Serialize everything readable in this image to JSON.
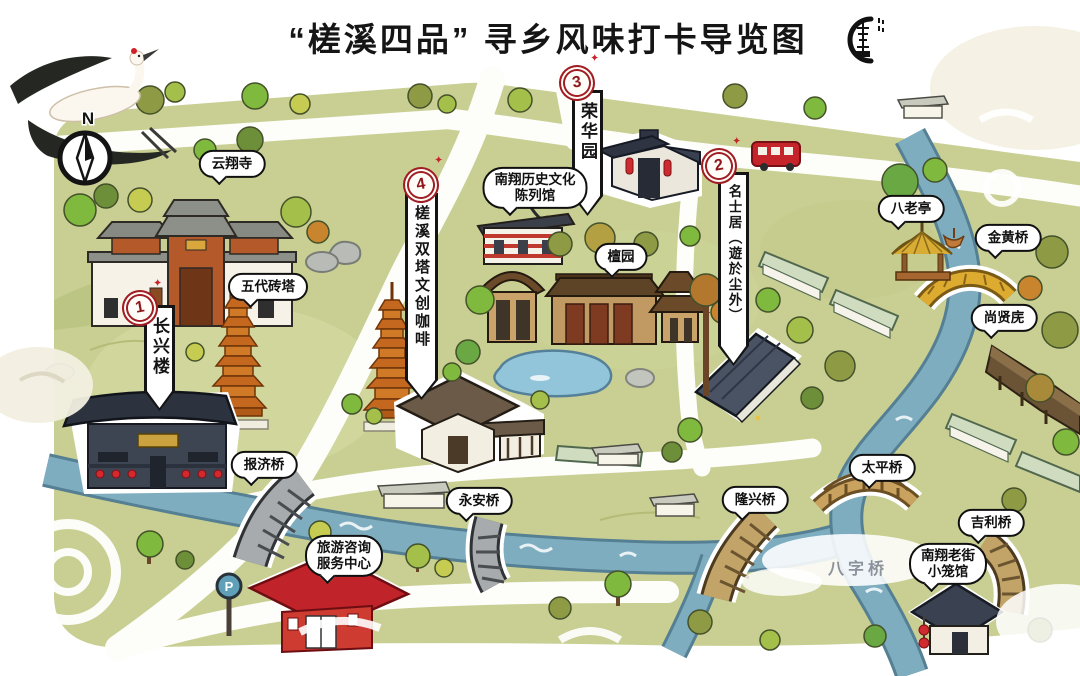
{
  "title": "“槎溪四品” 寻乡风味打卡导览图",
  "compass": {
    "label": "N"
  },
  "parking": {
    "label": "P"
  },
  "decor": {
    "sparkle": "✦"
  },
  "water_label": "八字桥",
  "markers": [
    {
      "num": "1",
      "label": "长兴楼"
    },
    {
      "num": "2",
      "label": "名士居（遊於尘外）"
    },
    {
      "num": "3",
      "label": "荣华园"
    },
    {
      "num": "4",
      "label": "槎溪双塔文创咖啡"
    }
  ],
  "bubbles": {
    "yunxiang_temple": "云翔寺",
    "five_dynasties_pagoda": "五代砖塔",
    "history_museum_line1": "南翔历史文化",
    "history_museum_line2": "陈列馆",
    "tan_garden": "檀园",
    "balao_pavilion": "八老亭",
    "jinhuang_bridge": "金黄桥",
    "shangxian_gallery": "尚贤庑",
    "baoji_bridge": "报济桥",
    "yongan_bridge": "永安桥",
    "longxing_bridge": "隆兴桥",
    "taiping_bridge": "太平桥",
    "jili_bridge": "吉利桥",
    "xiaolong_hall_line1": "南翔老街",
    "xiaolong_hall_line2": "小笼馆",
    "visitor_center_line1": "旅游咨询",
    "visitor_center_line2": "服务中心"
  },
  "colors": {
    "land_green": "#c9cf92",
    "river_blue": "#7fadc0",
    "road_white": "#fdfdf9",
    "marker_red": "#a01d24",
    "accent_red": "#c5242b",
    "pagoda_orange": "#c4671f",
    "bridge_gold": "#dcab30",
    "bridge_tan": "#c3a468",
    "ink": "#141414"
  }
}
